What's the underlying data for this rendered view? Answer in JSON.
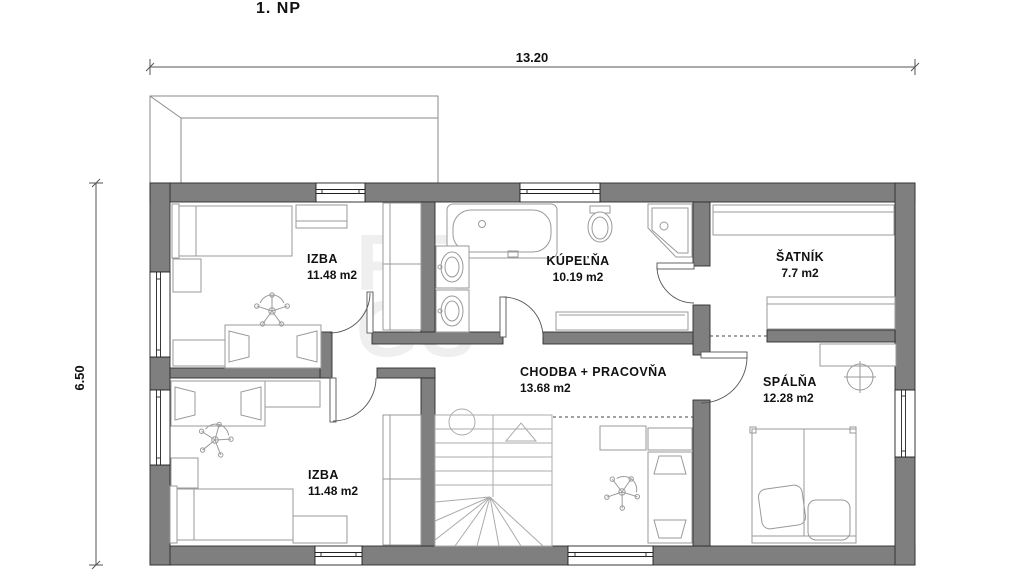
{
  "title": "1. NP",
  "dimensions": {
    "top": "13.20",
    "left": "6.50"
  },
  "rooms": {
    "izba_top": {
      "name": "IZBA",
      "area": "11.48 m2"
    },
    "kupelna": {
      "name": "KÚPEĽŇA",
      "area": "10.19 m2"
    },
    "satnik": {
      "name": "ŠATNÍK",
      "area": "7.7 m2"
    },
    "chodba": {
      "name": "CHODBA + PRACOVŇA",
      "area": "13.68 m2"
    },
    "spalna": {
      "name": "SPÁLŇA",
      "area": "12.28 m2"
    },
    "izba_bottom": {
      "name": "IZBA",
      "area": "11.48 m2"
    }
  },
  "watermark": {
    "line1": "PR",
    "line2": "GS"
  },
  "colors": {
    "wall": "#7f7f7f",
    "wall_outline": "#2e2e2e",
    "furniture": "#9a9a9a",
    "door": "#555555",
    "dimension": "#555555",
    "text": "#111111",
    "watermark": "#888888"
  }
}
